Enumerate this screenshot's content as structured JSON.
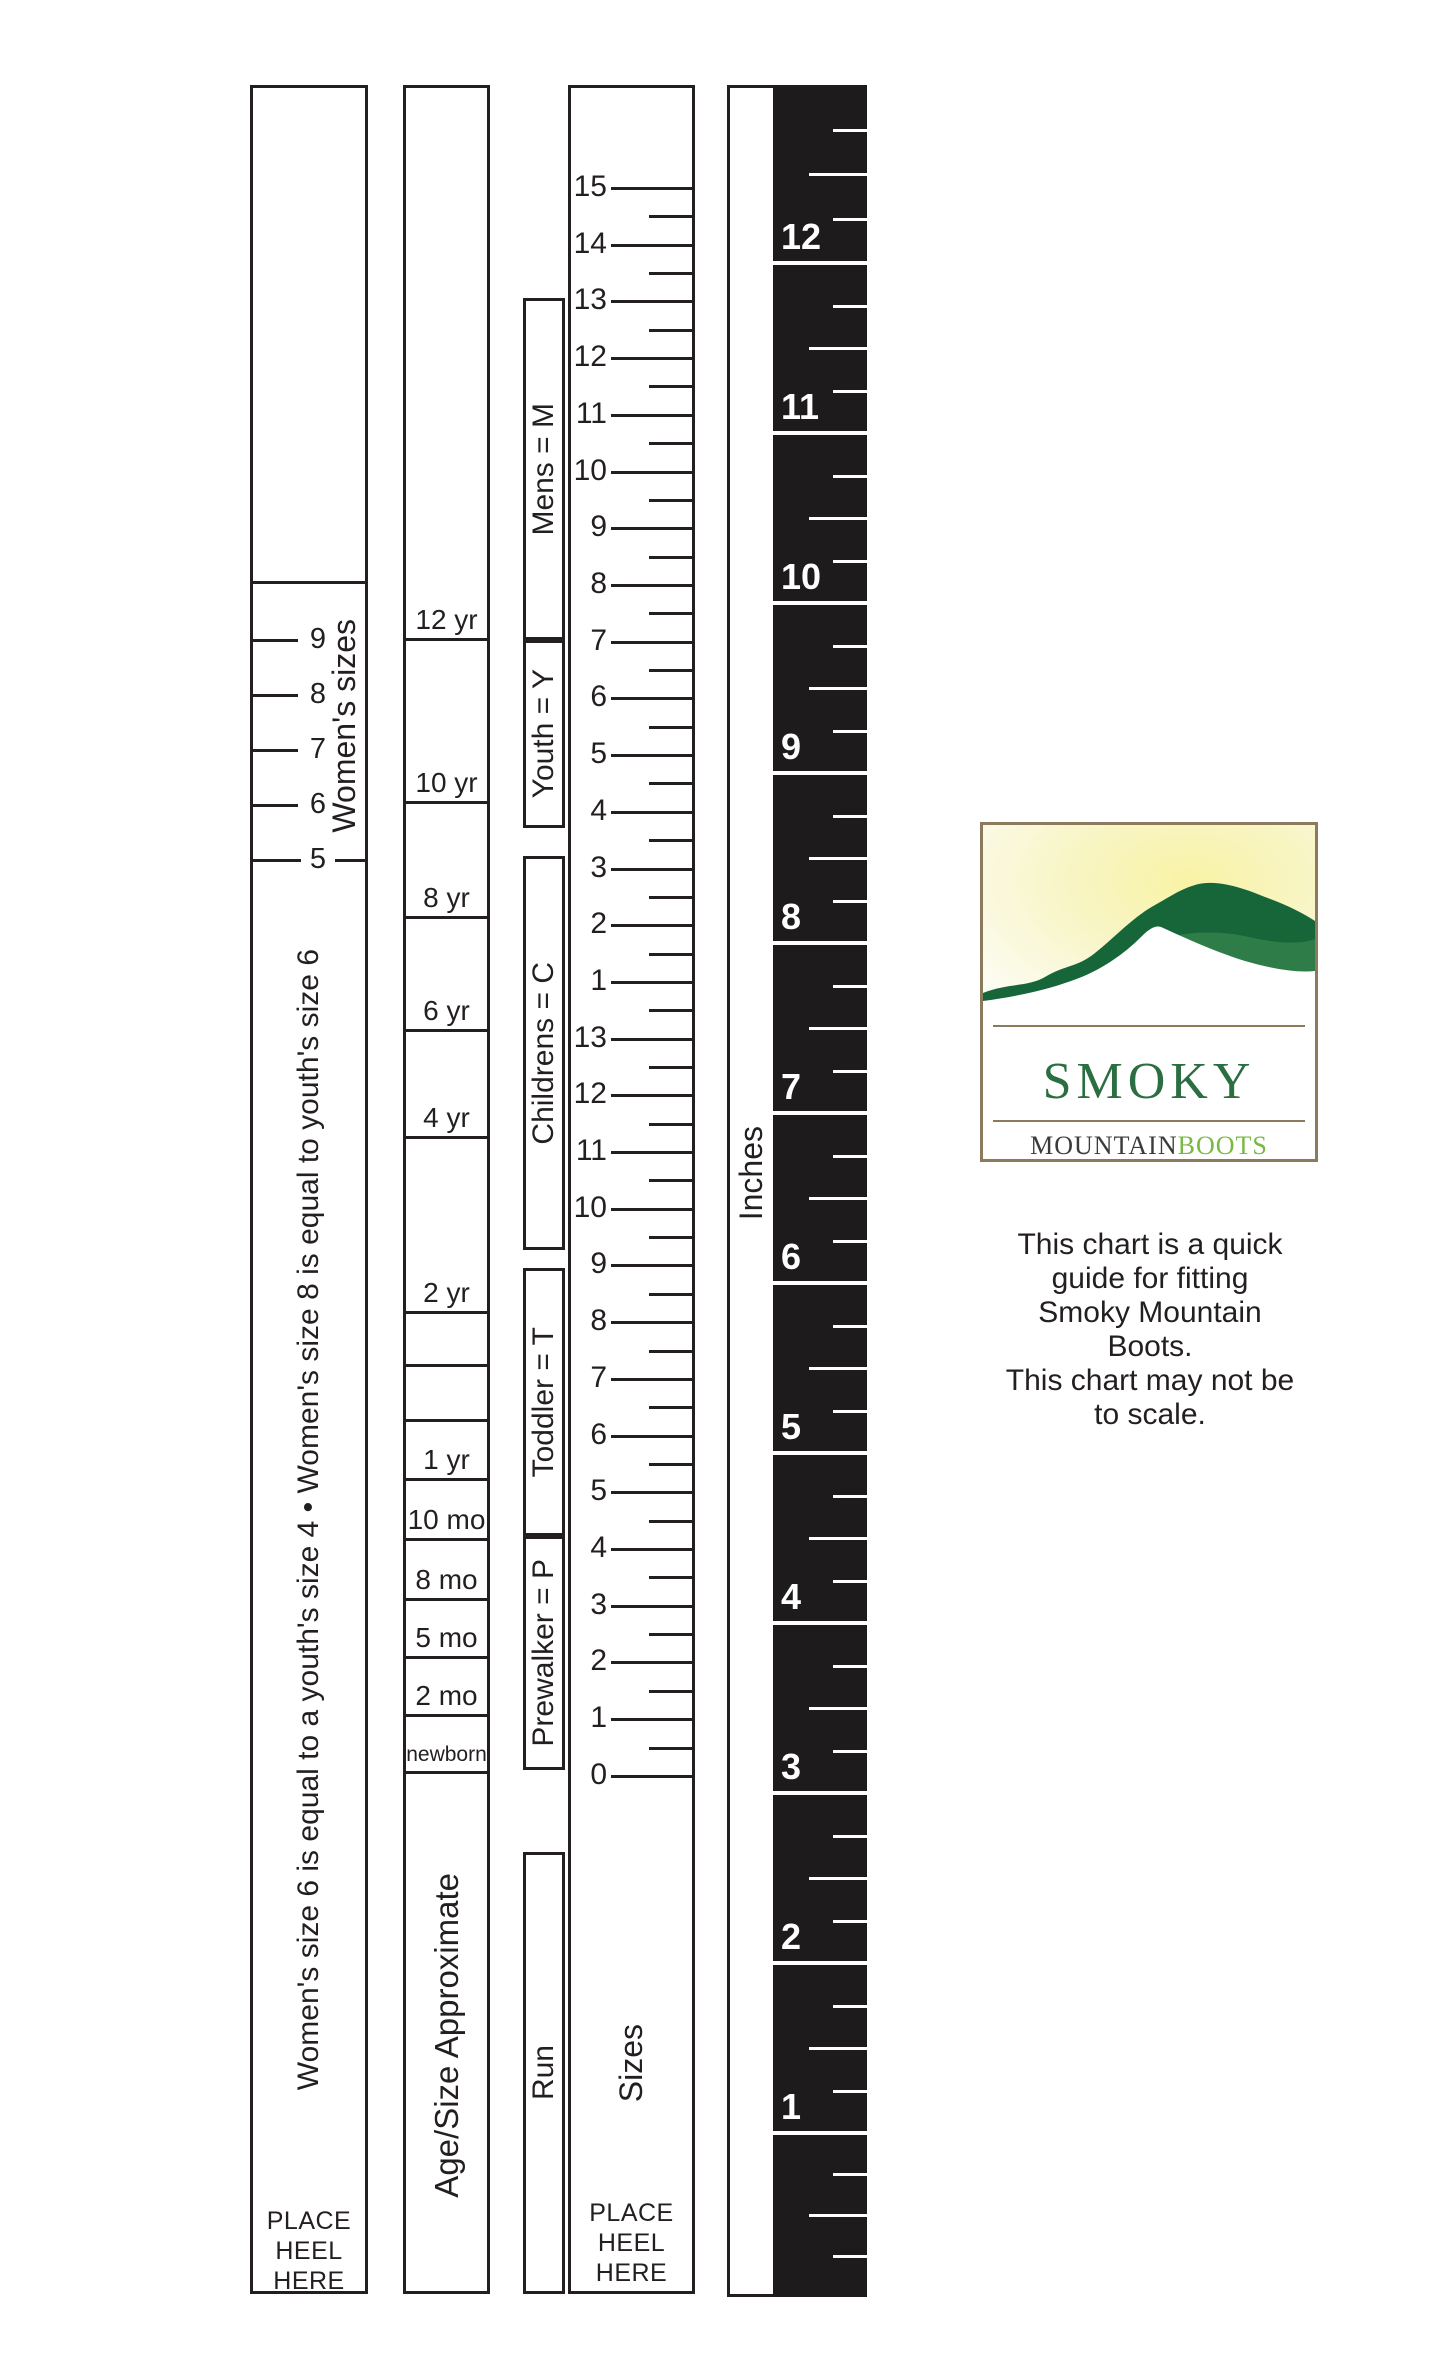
{
  "page": {
    "background": "#ffffff",
    "ink": "#231f20"
  },
  "womens_column": {
    "title": "Women's sizes",
    "tick_labels": [
      "9",
      "8",
      "7",
      "6"
    ],
    "boundary_label": "5",
    "note": "Women's size 6 is equal to a youth's size 4 • Women's size 8 is equal to youth's size 6",
    "place_heel": "PLACE\nHEEL\nHERE"
  },
  "age_column": {
    "title": "Age/Size Approximate",
    "cells": [
      "12 yr",
      "10 yr",
      "8 yr",
      "6 yr",
      "4 yr",
      "2 yr",
      "",
      "",
      "1 yr",
      "10 mo",
      "8 mo",
      "5 mo",
      "2 mo",
      "newborn"
    ]
  },
  "run_column": {
    "title": "Run",
    "boxes": [
      "Mens = M",
      "Youth = Y",
      "Childrens = C",
      "Toddler = T",
      "Prewalker = P"
    ]
  },
  "sizes_ruler": {
    "title": "Sizes",
    "labels": [
      "15",
      "14",
      "13",
      "12",
      "11",
      "10",
      "9",
      "8",
      "7",
      "6",
      "5",
      "4",
      "3",
      "2",
      "1",
      "13",
      "12",
      "11",
      "10",
      "9",
      "8",
      "7",
      "6",
      "5",
      "4",
      "3",
      "2",
      "1",
      "0"
    ],
    "place_heel": "PLACE\nHEEL\nHERE"
  },
  "inches_ruler": {
    "title": "Inches",
    "labels": [
      "12",
      "11",
      "10",
      "9",
      "8",
      "7",
      "6",
      "5",
      "4",
      "3",
      "2",
      "1"
    ]
  },
  "logo": {
    "word_smoky": "Smoky",
    "word_mountain": "Mountain",
    "word_boots": "Boots",
    "color_smoky": "#2b6e41",
    "color_mountain": "#3b3b3b",
    "color_boots": "#79b843",
    "color_hill_dark": "#17663a",
    "color_hill_light": "#2e7c48",
    "color_sky": "#f9f5b4",
    "color_border": "#8b7a5c"
  },
  "disclaimer": "This chart is a quick\nguide for fitting\nSmoky Mountain\nBoots.\nThis chart may not be\nto scale."
}
